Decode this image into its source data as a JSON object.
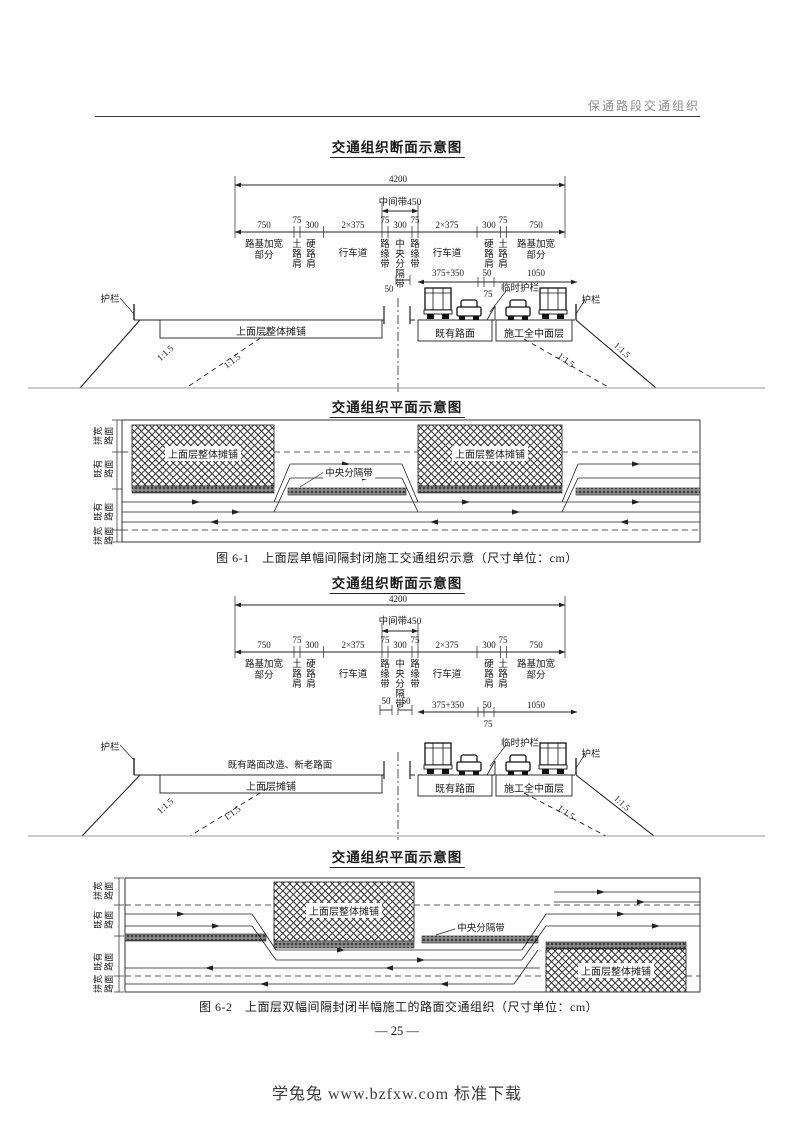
{
  "page": {
    "header": "保通路段交通组织",
    "page_number": "— 25 —",
    "footer": "学兔兔 www.bzfxw.com 标准下载"
  },
  "fig1": {
    "cross_title": "交通组织断面示意图",
    "plan_title": "交通组织平面示意图",
    "caption": "图 6-1　上面层单幅间隔封闭施工交通组织示意（尺寸单位：cm）",
    "cross": {
      "total": "4200",
      "median_band": "中间带450",
      "dims": [
        "750",
        "75",
        "300",
        "2×375",
        "75",
        "300",
        "75",
        "2×375",
        "300",
        "75",
        "750"
      ],
      "labels": [
        "路基加宽\n部分",
        "土路肩",
        "硬路肩",
        "行车道",
        "路缘带",
        "中央分隔带",
        "路缘带",
        "行车道",
        "硬路肩",
        "土路肩",
        "路基加宽\n部分"
      ],
      "sub": {
        "gap50_l": "50",
        "lane": "375+350",
        "gap50_r": "50",
        "gap75": "75",
        "widen": "1050"
      },
      "rail_left": "护栏",
      "rail_right": "护栏",
      "temp_rail": "临时护栏",
      "box_paving": "上面层整体摊铺",
      "box_existing": "既有路面",
      "box_construction": "施工全中面层",
      "slope": "1:1.5"
    },
    "plan": {
      "side": [
        "拼宽\n路面",
        "既有\n路面",
        "既有\n路面",
        "拼宽\n路面"
      ],
      "block_label": "上面层整体摊铺",
      "median_label": "中央分隔带"
    }
  },
  "fig2": {
    "cross_title": "交通组织断面示意图",
    "plan_title": "交通组织平面示意图",
    "caption": "图 6-2　上面层双幅间隔封闭半幅施工的路面交通组织（尺寸单位：cm）",
    "cross": {
      "total": "4200",
      "median_band": "中间带450",
      "dims": [
        "750",
        "75",
        "300",
        "2×375",
        "75",
        "300",
        "75",
        "2×375",
        "300",
        "75",
        "750"
      ],
      "labels": [
        "路基加宽\n部分",
        "土路肩",
        "硬路肩",
        "行车道",
        "路缘带",
        "中央分隔带",
        "路缘带",
        "行车道",
        "硬路肩",
        "土路肩",
        "路基加宽\n部分"
      ],
      "sub": {
        "gap50_ll": "50",
        "gap50_l": "50",
        "lane": "375+350",
        "gap50_r": "50",
        "gap75": "75",
        "widen": "1050"
      },
      "note": "既有路面改造、新老路面",
      "rail_left": "护栏",
      "rail_right": "护栏",
      "temp_rail": "临时护栏",
      "box_paving": "上面层摊铺",
      "box_existing": "既有路面",
      "box_construction": "施工全中面层",
      "slope": "1:1.5"
    },
    "plan": {
      "side": [
        "拼宽\n路面",
        "既有\n路面",
        "既有\n路面",
        "拼宽\n路面"
      ],
      "block_label": "上面层整体摊铺",
      "median_label": "中央分隔带"
    }
  }
}
